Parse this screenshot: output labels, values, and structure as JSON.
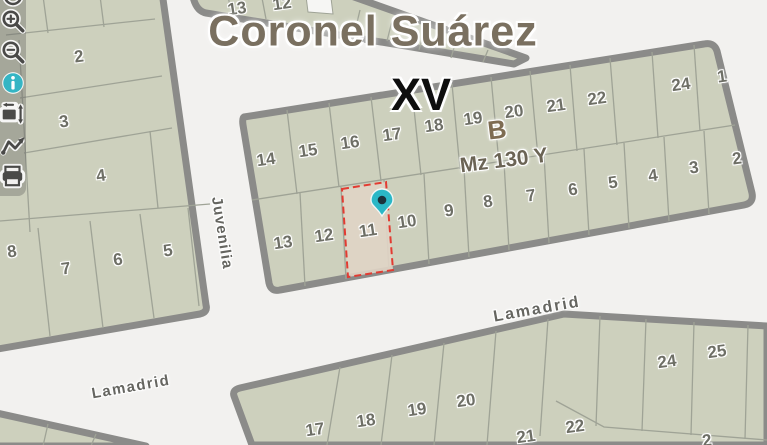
{
  "map": {
    "title": "Coronel Suárez",
    "section": "XV",
    "block_letter": "B",
    "block_code": "Mz 130 Y",
    "selected_parcel": "11",
    "streets": [
      {
        "name": "Juvenilia"
      },
      {
        "name": "Lamadrid",
        "instance": "center"
      },
      {
        "name": "Lamadrid",
        "instance": "left"
      }
    ],
    "parcel_numbers": [
      {
        "label": "2",
        "x": 79,
        "y": 57
      },
      {
        "label": "3",
        "x": 64,
        "y": 122
      },
      {
        "label": "4",
        "x": 101,
        "y": 176
      },
      {
        "label": "8",
        "x": 12,
        "y": 252
      },
      {
        "label": "7",
        "x": 66,
        "y": 269
      },
      {
        "label": "6",
        "x": 118,
        "y": 260
      },
      {
        "label": "5",
        "x": 168,
        "y": 251
      },
      {
        "label": "13",
        "x": 237,
        "y": 9
      },
      {
        "label": "12",
        "x": 282,
        "y": 4
      },
      {
        "label": "14",
        "x": 266,
        "y": 160
      },
      {
        "label": "15",
        "x": 308,
        "y": 151
      },
      {
        "label": "16",
        "x": 350,
        "y": 143
      },
      {
        "label": "17",
        "x": 392,
        "y": 135
      },
      {
        "label": "18",
        "x": 434,
        "y": 126
      },
      {
        "label": "19",
        "x": 473,
        "y": 119
      },
      {
        "label": "20",
        "x": 514,
        "y": 112
      },
      {
        "label": "21",
        "x": 556,
        "y": 106
      },
      {
        "label": "22",
        "x": 597,
        "y": 99
      },
      {
        "label": "24",
        "x": 681,
        "y": 85
      },
      {
        "label": "1",
        "x": 722,
        "y": 77
      },
      {
        "label": "13",
        "x": 283,
        "y": 243
      },
      {
        "label": "12",
        "x": 324,
        "y": 236
      },
      {
        "label": "11",
        "x": 368,
        "y": 231
      },
      {
        "label": "10",
        "x": 407,
        "y": 222
      },
      {
        "label": "9",
        "x": 449,
        "y": 211
      },
      {
        "label": "8",
        "x": 488,
        "y": 202
      },
      {
        "label": "7",
        "x": 531,
        "y": 196
      },
      {
        "label": "6",
        "x": 573,
        "y": 190
      },
      {
        "label": "5",
        "x": 613,
        "y": 183
      },
      {
        "label": "4",
        "x": 653,
        "y": 176
      },
      {
        "label": "3",
        "x": 694,
        "y": 168
      },
      {
        "label": "2",
        "x": 737,
        "y": 159
      },
      {
        "label": "17",
        "x": 315,
        "y": 430
      },
      {
        "label": "18",
        "x": 366,
        "y": 421
      },
      {
        "label": "19",
        "x": 417,
        "y": 410
      },
      {
        "label": "20",
        "x": 466,
        "y": 401
      },
      {
        "label": "21",
        "x": 526,
        "y": 437
      },
      {
        "label": "22",
        "x": 575,
        "y": 427
      },
      {
        "label": "24",
        "x": 667,
        "y": 362
      },
      {
        "label": "25",
        "x": 717,
        "y": 352
      },
      {
        "label": "2",
        "x": 707,
        "y": 441
      }
    ],
    "colors": {
      "street": "#f2f1ef",
      "parcel": "#cdd0bd",
      "block_border": "#8b8b89",
      "parcel_line": "#9fa396",
      "highlight_fill": "#e0d4c5",
      "highlight_border": "#e23b32",
      "pin": "#2bb7c6",
      "pin_center": "#1b323c",
      "title": "#7a7060",
      "section": "#0e0e0e",
      "block_letter": "#7e6c52",
      "block_code": "#6b6455",
      "street_label": "#656560",
      "parcel_number": "#6e6f66",
      "toolbar_bg": "rgba(100,100,96,0.38)",
      "icon": "#4a4a48",
      "info_icon": "#35b5c4"
    }
  },
  "toolbar": {
    "icons": [
      {
        "name": "clipped-top"
      },
      {
        "name": "zoom-in"
      },
      {
        "name": "zoom-out"
      },
      {
        "name": "info"
      },
      {
        "name": "extent"
      },
      {
        "name": "measure-path"
      },
      {
        "name": "print"
      }
    ]
  }
}
